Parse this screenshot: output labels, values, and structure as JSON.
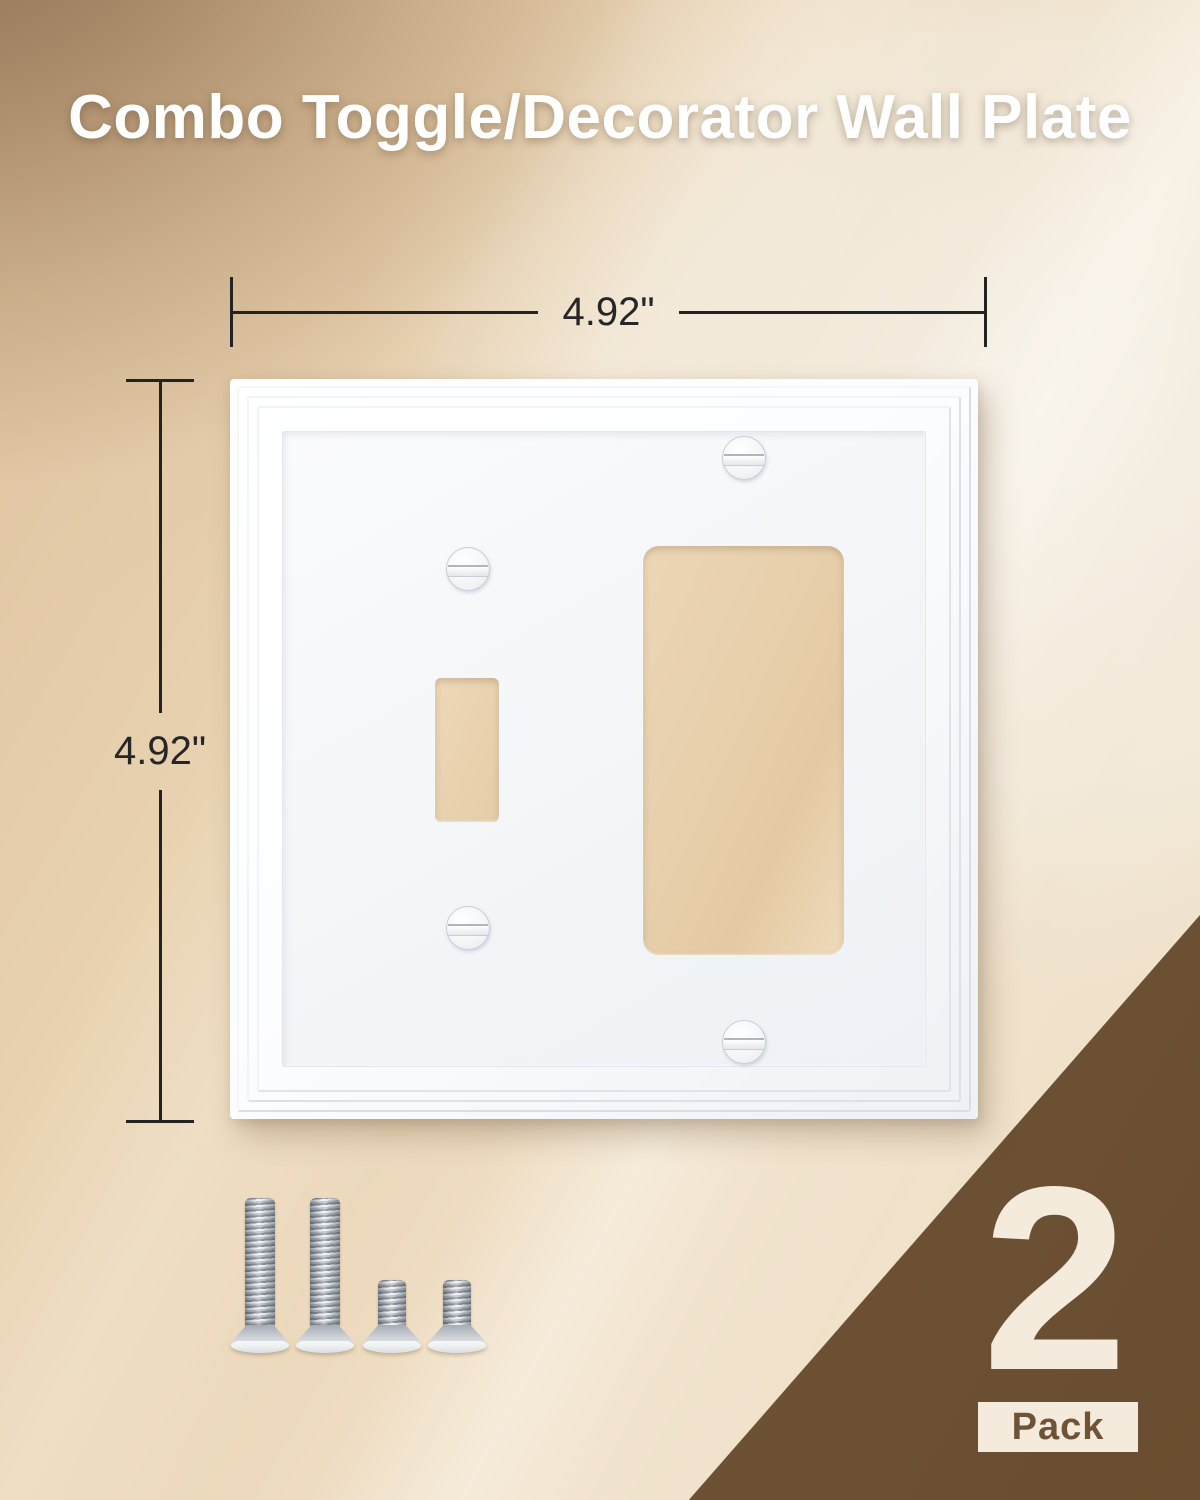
{
  "title": "Combo Toggle/Decorator Wall Plate",
  "dimension_width": {
    "label": "4.92\""
  },
  "dimension_height": {
    "label": "4.92\""
  },
  "badge": {
    "count": "2",
    "unit": "Pack"
  },
  "plate": {
    "openings": {
      "toggle": 1,
      "decorator": 1
    },
    "plate_screws": 4
  },
  "hardware": {
    "long_screws": 2,
    "short_screws": 2
  },
  "colors": {
    "background_top_left": "#8f7254",
    "background_cream": "#eedcc1",
    "plate_white": "#ffffff",
    "cutout_tan": "#e7cfab",
    "dimension_line": "#232323",
    "accent_brown": "#73563a",
    "badge_cream": "#f4ebdc",
    "screw_silver": "#c2c7cd",
    "title_text": "#ffffff"
  }
}
